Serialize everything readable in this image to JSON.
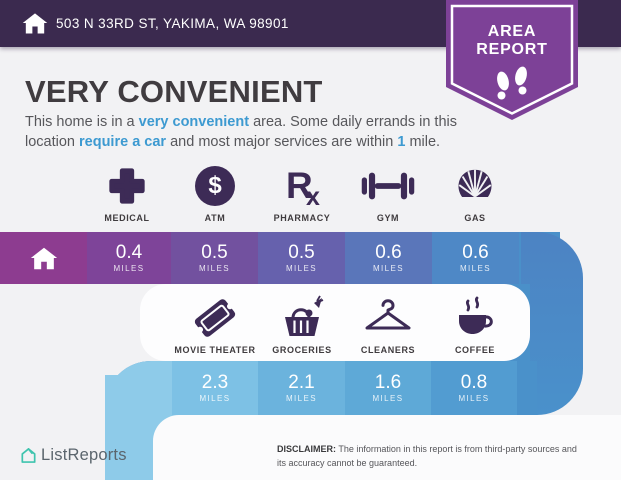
{
  "header": {
    "address": "503 N 33RD ST, YAKIMA, WA 98901",
    "badge": {
      "line1": "AREA",
      "line2": "REPORT"
    }
  },
  "summary": {
    "title": "VERY CONVENIENT",
    "p1": "This home is in a ",
    "p2": "very convenient",
    "p3": " area. Some daily errands in this location ",
    "p4": "require a car",
    "p5": " and most major services are within ",
    "p6": "1",
    "p7": " mile."
  },
  "icons": {
    "atm_symbol": "$",
    "pharmacy_r": "R",
    "pharmacy_x": "x"
  },
  "amenities": {
    "row1": {
      "items": [
        {
          "label": "MEDICAL",
          "icon": "medical-cross-icon",
          "distance": "0.4",
          "unit": "MILES"
        },
        {
          "label": "ATM",
          "icon": "atm-dollar-icon",
          "distance": "0.5",
          "unit": "MILES"
        },
        {
          "label": "PHARMACY",
          "icon": "pharmacy-rx-icon",
          "distance": "0.5",
          "unit": "MILES"
        },
        {
          "label": "GYM",
          "icon": "gym-dumbbell-icon",
          "distance": "0.6",
          "unit": "MILES"
        },
        {
          "label": "GAS",
          "icon": "gas-shell-icon",
          "distance": "0.6",
          "unit": "MILES"
        }
      ]
    },
    "row2": {
      "items": [
        {
          "label": "MOVIE THEATER",
          "icon": "movie-ticket-icon",
          "distance": "2.3",
          "unit": "MILES"
        },
        {
          "label": "GROCERIES",
          "icon": "grocery-basket-icon",
          "distance": "2.1",
          "unit": "MILES"
        },
        {
          "label": "CLEANERS",
          "icon": "hanger-icon",
          "distance": "1.6",
          "unit": "MILES"
        },
        {
          "label": "COFFEE",
          "icon": "coffee-cup-icon",
          "distance": "0.8",
          "unit": "MILES"
        }
      ]
    }
  },
  "footer": {
    "brand": "ListReports",
    "disclaimer_label": "DISCLAIMER:",
    "disclaimer_text": " The information in this report is from third-party sources and its accuracy cannot be guaranteed."
  },
  "colors": {
    "header_purple": "#3b2a4f",
    "badge_purple": "#7d4197",
    "icon_purple": "#3d2b56",
    "link_blue": "#3d9ad1",
    "brand_teal": "#3fc4ae",
    "band1_segments": [
      "#8d3c90",
      "#7e4499",
      "#72519f",
      "#6661ad",
      "#5a76ba",
      "#4e88c6",
      "#4a90c9"
    ],
    "band2_segments": [
      "#8ecbe9",
      "#7dc1e5",
      "#6bb3dd",
      "#5ea9d7",
      "#529cd1",
      "#4a91ca"
    ]
  }
}
